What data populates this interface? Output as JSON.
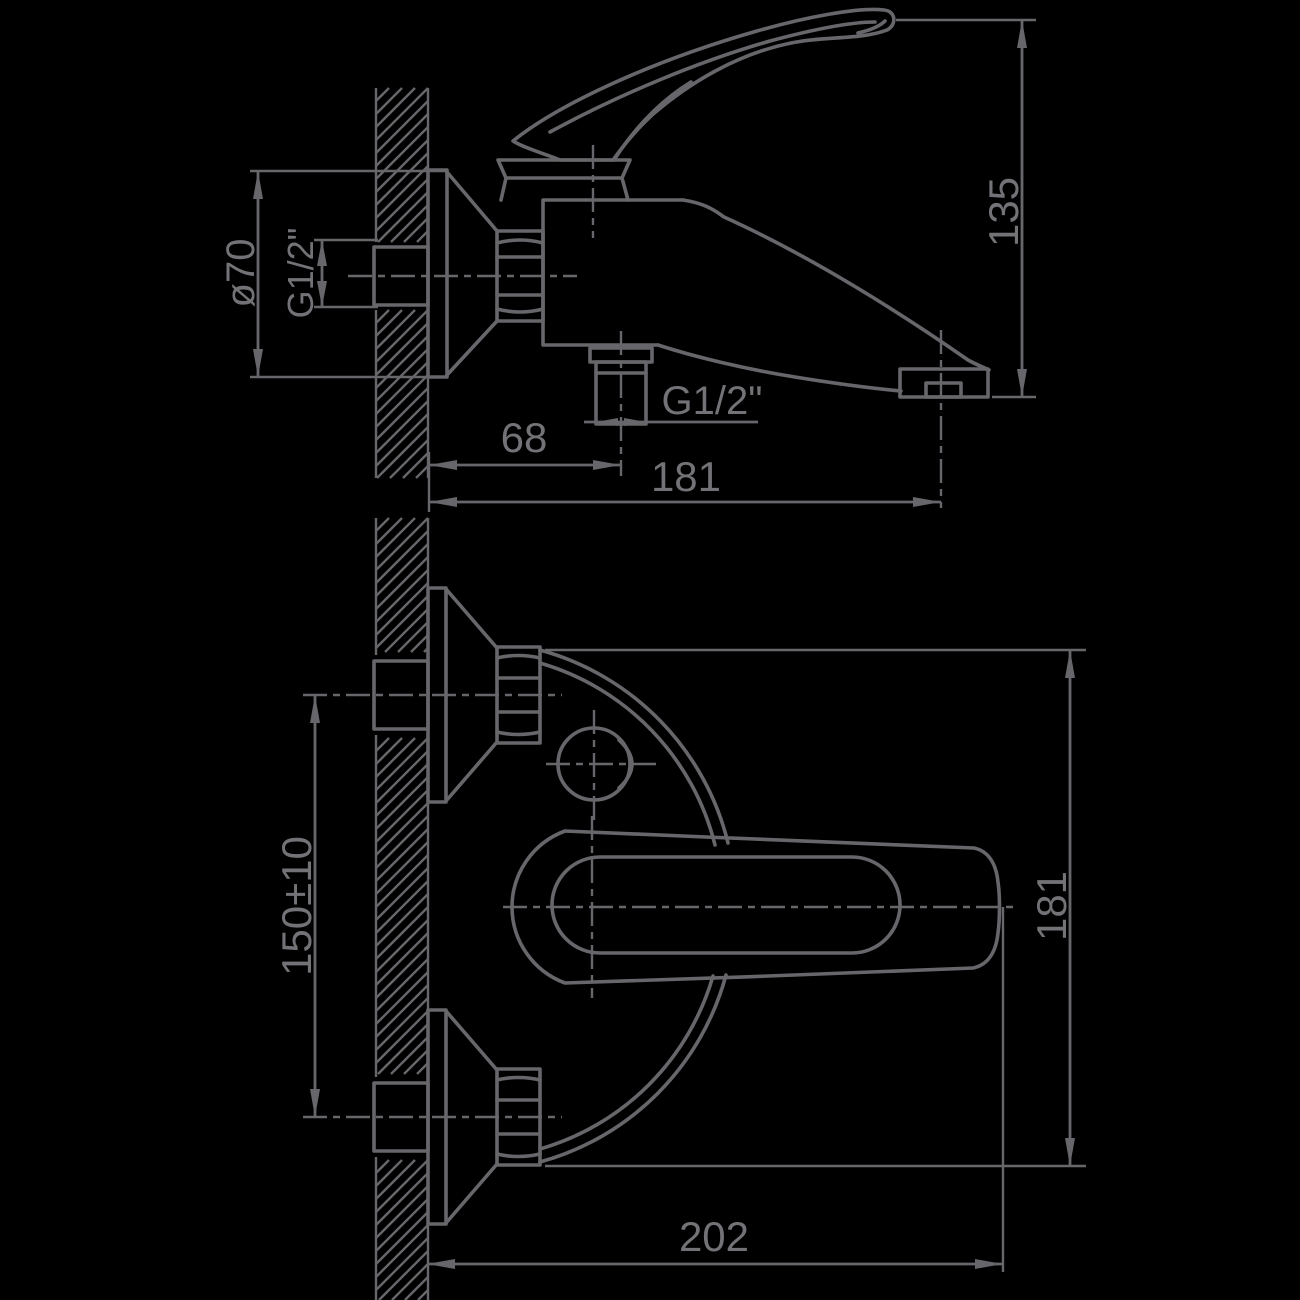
{
  "drawing": {
    "type": "technical-dimension-drawing",
    "subject": "wall-mounted single-lever bath mixer faucet, two orthographic views",
    "background_color": "#000000",
    "line_color": "#67676b"
  },
  "dims": {
    "escutcheon_diameter": "ø70",
    "wall_thread": "G1/2\"",
    "overall_height": "135",
    "shower_offset": "68",
    "spout_reach": "181",
    "shower_thread": "G1/2\"",
    "pipe_centers": "150±10",
    "body_span": "181",
    "overall_width": "202"
  }
}
